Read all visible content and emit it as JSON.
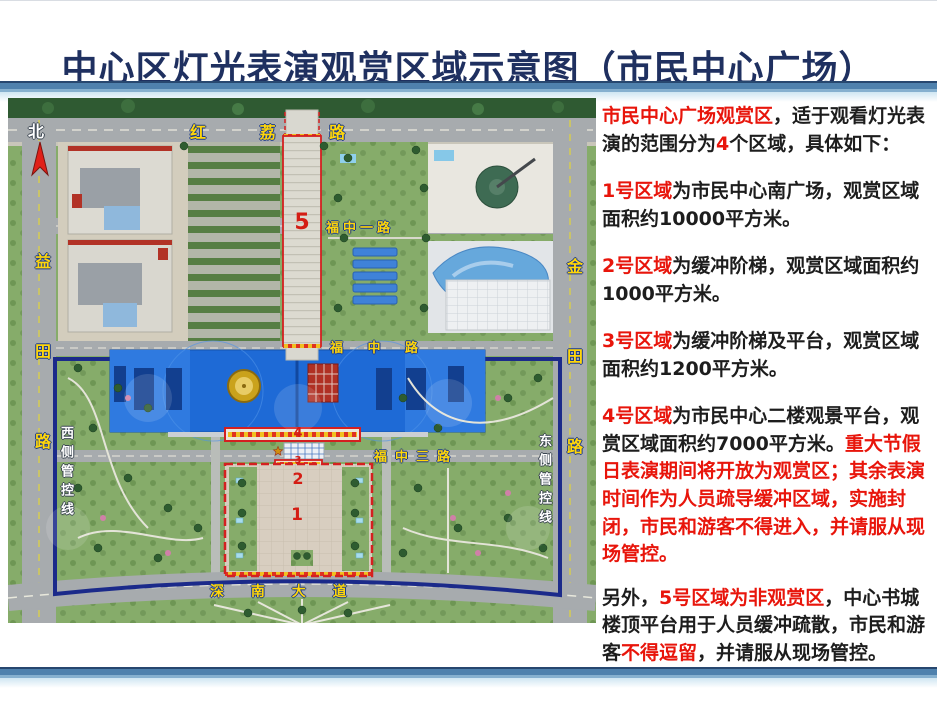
{
  "title": "中心区灯光表演观赏区域示意图（市民中心广场）",
  "map": {
    "north": "北",
    "roads": {
      "honglilu": "红 荔 路",
      "yitianlu": "益田路",
      "jintianlu": "金田路",
      "fuzhongyilu": "福中一路",
      "fuzhonglu": "福 中 路",
      "fuzhongsanlu": "福中三路",
      "shennandadao": "深 南 大 道"
    },
    "control_lines": {
      "west": "西侧管控线",
      "east": "东侧管控线"
    },
    "zones": {
      "z1": "1",
      "z2": "2",
      "z3": "3",
      "z4": "4",
      "z5": "5"
    }
  },
  "panel": {
    "paragraphs": [
      {
        "segments": [
          {
            "text": "市民中心广场观赏区",
            "red": true
          },
          {
            "text": "，适于观看灯光表演的范围分为",
            "red": false
          },
          {
            "text": "4",
            "red": true
          },
          {
            "text": "个区域，具体如下：",
            "red": false
          }
        ]
      },
      {
        "segments": [
          {
            "text": "1号区域",
            "red": true
          },
          {
            "text": "为市民中心南广场，观赏区域面积约10000平方米。",
            "red": false
          }
        ]
      },
      {
        "segments": [
          {
            "text": "2号区域",
            "red": true
          },
          {
            "text": "为缓冲阶梯，观赏区域面积约1000平方米。",
            "red": false
          }
        ]
      },
      {
        "segments": [
          {
            "text": "3号区域",
            "red": true
          },
          {
            "text": "为缓冲阶梯及平台，观赏区域面积约1200平方米。",
            "red": false
          }
        ]
      },
      {
        "segments": [
          {
            "text": "4号区域",
            "red": true
          },
          {
            "text": "为市民中心二楼观景平台，观赏区域面积约7000平方米。",
            "red": false
          },
          {
            "text": "重大节假日表演期间将开放为观赏区；其余表演时间作为人员疏导缓冲区域，实施封闭，市民和游客不得进入，并请服从现场管控。",
            "red": true
          }
        ]
      },
      {
        "segments": [
          {
            "text": "另外，",
            "red": false
          },
          {
            "text": "5号区域为非观赏区",
            "red": true
          },
          {
            "text": "，中心书城楼顶平台用于人员缓冲疏散，市民和游客",
            "red": false
          },
          {
            "text": "不得逗留",
            "red": true
          },
          {
            "text": "，并请服从现场管控。",
            "red": false
          }
        ]
      }
    ]
  },
  "colors": {
    "title_navy": "#1f3060",
    "text_red": "#e8150b",
    "bar_steel": "#4f81ad",
    "zone_red": "#d42020",
    "civic_blue": "#1e6ad6",
    "boundary_navy": "#1b2a8a",
    "road_label_yellow": "#ffd60a"
  }
}
